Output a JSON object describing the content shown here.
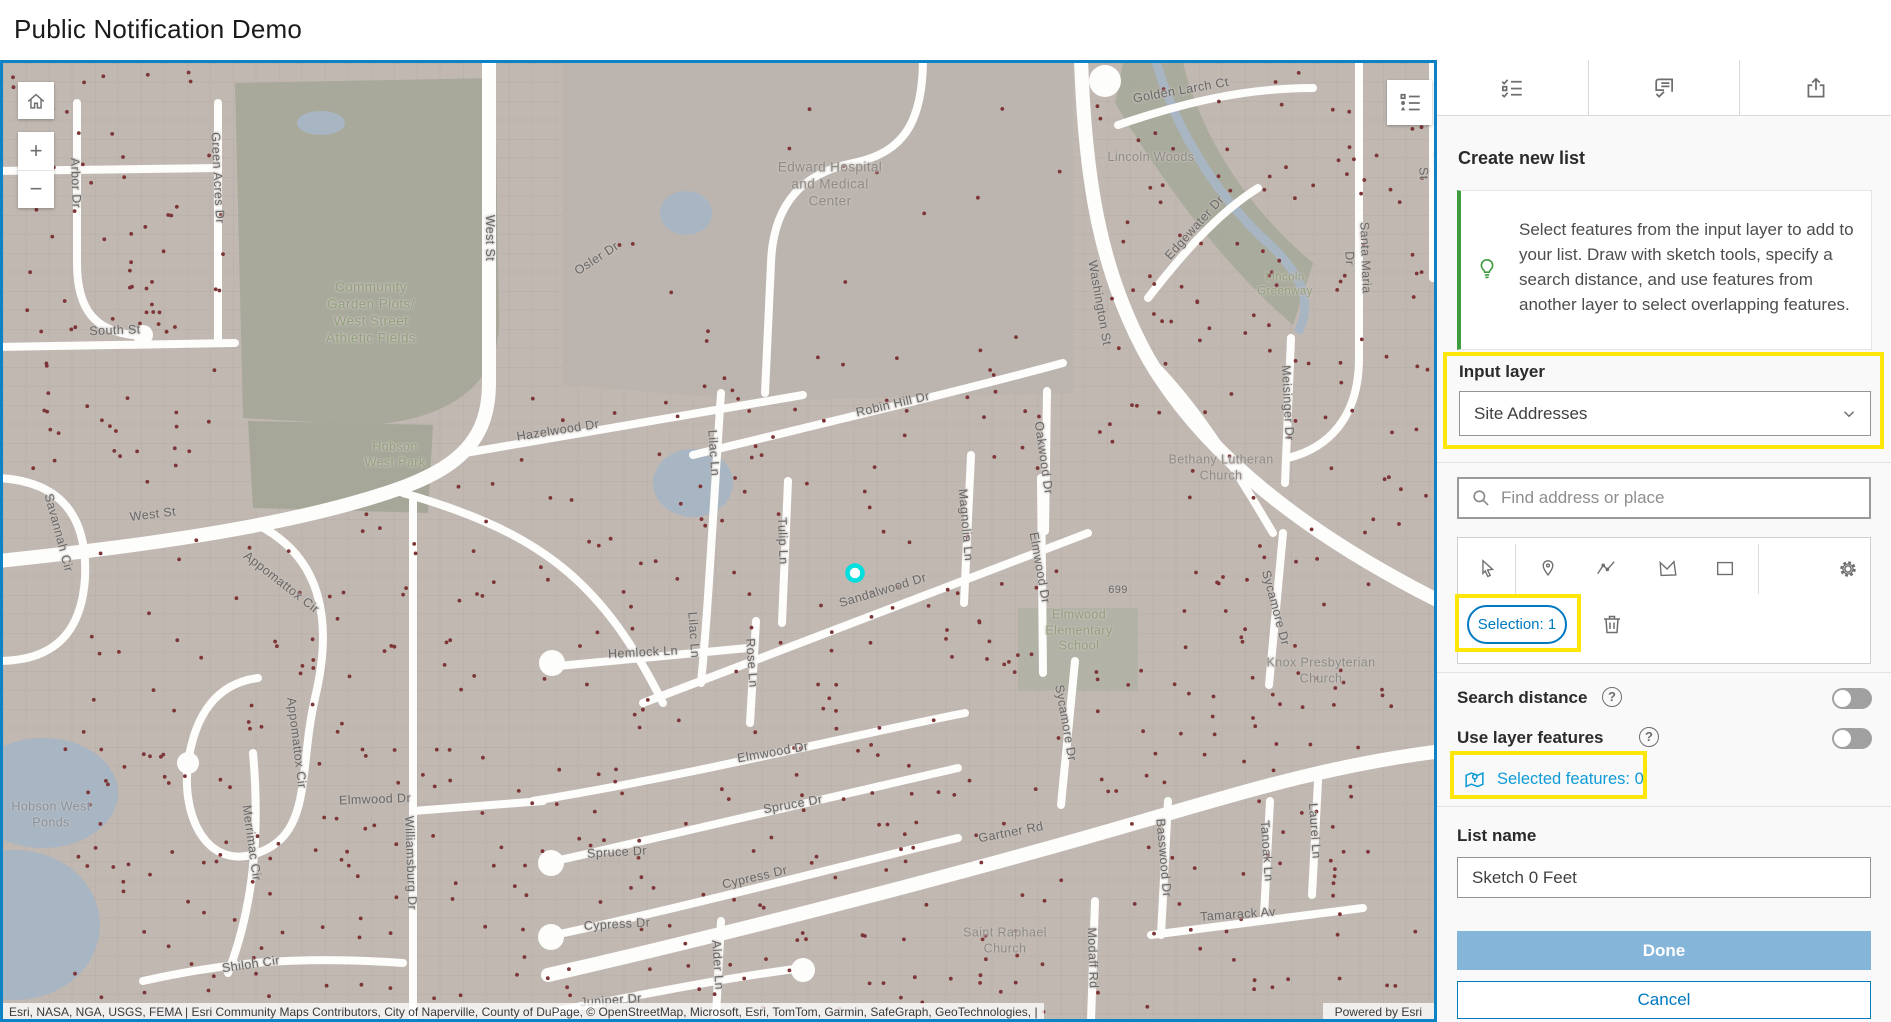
{
  "header": {
    "title": "Public Notification Demo"
  },
  "map": {
    "attribution": "Esri, NASA, NGA, USGS, FEMA | Esri Community Maps Contributors, City of Naperville, County of DuPage, © OpenStreetMap, Microsoft, Esri, TomTom, Garmin, SafeGraph, GeoTechnologies, |",
    "powered_by": "Powered by Esri",
    "controls": {
      "zoom_in": "+",
      "zoom_out": "−"
    },
    "selected_point": {
      "x": 852,
      "y": 510
    },
    "colors": {
      "base": "#c1b8b2",
      "park": "#a8a99b",
      "water": "#a8b5c3",
      "dots": "#7d3537",
      "road": "#fdfdfc",
      "border": "#0d82c4",
      "highlight": "#ffe60a",
      "marker_ring": "#00dede"
    },
    "labels": [
      {
        "t": "West St",
        "x": 486,
        "y": 175,
        "r": 90,
        "c": "st"
      },
      {
        "t": "West St",
        "x": 150,
        "y": 452,
        "r": -7,
        "c": "st"
      },
      {
        "t": "Green Acres Dr",
        "x": 214,
        "y": 115,
        "r": 87,
        "c": "st"
      },
      {
        "t": "Arbor Dr",
        "x": 72,
        "y": 120,
        "r": 88,
        "c": "st"
      },
      {
        "t": "South St",
        "x": 112,
        "y": 268,
        "r": -2,
        "c": "st"
      },
      {
        "t": "Savannah Cir",
        "x": 55,
        "y": 470,
        "r": 75,
        "c": "st"
      },
      {
        "t": "Appomattox Cir",
        "x": 278,
        "y": 520,
        "r": 38,
        "c": "st"
      },
      {
        "t": "Appomattox Cir",
        "x": 293,
        "y": 680,
        "r": 83,
        "c": "st"
      },
      {
        "t": "Merrimac Cir",
        "x": 248,
        "y": 780,
        "r": 82,
        "c": "st"
      },
      {
        "t": "Williamsburg Dr",
        "x": 407,
        "y": 800,
        "r": 88,
        "c": "st"
      },
      {
        "t": "Shiloh Cir",
        "x": 248,
        "y": 902,
        "r": -8,
        "c": "st"
      },
      {
        "t": "Hazelwood Dr",
        "x": 555,
        "y": 368,
        "r": -9,
        "c": "st"
      },
      {
        "t": "Osler Dr",
        "x": 594,
        "y": 196,
        "r": -33,
        "c": "st"
      },
      {
        "t": "Robin Hill Dr",
        "x": 890,
        "y": 342,
        "r": -13,
        "c": "st"
      },
      {
        "t": "Lilac Ln",
        "x": 710,
        "y": 390,
        "r": 86,
        "c": "st"
      },
      {
        "t": "Lilac Ln",
        "x": 690,
        "y": 572,
        "r": 86,
        "c": "st"
      },
      {
        "t": "Tulip Ln",
        "x": 779,
        "y": 478,
        "r": 88,
        "c": "st"
      },
      {
        "t": "Rose Ln",
        "x": 748,
        "y": 600,
        "r": 86,
        "c": "st"
      },
      {
        "t": "Sandalwood Dr",
        "x": 880,
        "y": 528,
        "r": -17,
        "c": "st"
      },
      {
        "t": "Hemlock Ln",
        "x": 640,
        "y": 590,
        "r": -3,
        "c": "st"
      },
      {
        "t": "Elmwood Dr",
        "x": 1036,
        "y": 505,
        "r": 80,
        "c": "st"
      },
      {
        "t": "Elmwood Dr",
        "x": 770,
        "y": 690,
        "r": -10,
        "c": "st"
      },
      {
        "t": "Elmwood Dr",
        "x": 372,
        "y": 737,
        "r": -2,
        "c": "st"
      },
      {
        "t": "Oakwood Dr",
        "x": 1040,
        "y": 395,
        "r": 82,
        "c": "st"
      },
      {
        "t": "Magnolia Ln",
        "x": 962,
        "y": 462,
        "r": 85,
        "c": "st"
      },
      {
        "t": "Spruce Dr",
        "x": 790,
        "y": 742,
        "r": -10,
        "c": "st"
      },
      {
        "t": "Spruce Dr",
        "x": 614,
        "y": 790,
        "r": -3,
        "c": "st"
      },
      {
        "t": "Cypress Dr",
        "x": 752,
        "y": 815,
        "r": -13,
        "c": "st"
      },
      {
        "t": "Cypress Dr",
        "x": 614,
        "y": 862,
        "r": -3,
        "c": "st"
      },
      {
        "t": "Alder Ln",
        "x": 714,
        "y": 902,
        "r": 86,
        "c": "st"
      },
      {
        "t": "Juniper Dr",
        "x": 608,
        "y": 938,
        "r": -4,
        "c": "st"
      },
      {
        "t": "Gartner Rd",
        "x": 1008,
        "y": 770,
        "r": -11,
        "c": "st"
      },
      {
        "t": "Sycamore Dr",
        "x": 1062,
        "y": 660,
        "r": 80,
        "c": "st"
      },
      {
        "t": "Sycamore Dr",
        "x": 1272,
        "y": 545,
        "r": 75,
        "c": "st"
      },
      {
        "t": "Washington St",
        "x": 1096,
        "y": 240,
        "r": 80,
        "c": "st"
      },
      {
        "t": "Edgewater Dr",
        "x": 1192,
        "y": 165,
        "r": -48,
        "c": "st"
      },
      {
        "t": "Santa Maria Dr",
        "x": 1354,
        "y": 195,
        "r": 88,
        "c": "st"
      },
      {
        "t": "Meisinger Dr",
        "x": 1284,
        "y": 340,
        "r": 87,
        "c": "st"
      },
      {
        "t": "Golden Larch Ct",
        "x": 1178,
        "y": 28,
        "r": -10,
        "c": "st"
      },
      {
        "t": "Loomis St",
        "x": 1428,
        "y": 110,
        "r": 88,
        "c": "st"
      },
      {
        "t": "Tamarack Av",
        "x": 1235,
        "y": 852,
        "r": -4,
        "c": "st"
      },
      {
        "t": "Tanoak Ln",
        "x": 1263,
        "y": 788,
        "r": 86,
        "c": "st"
      },
      {
        "t": "Laurel Ln",
        "x": 1311,
        "y": 768,
        "r": 86,
        "c": "st"
      },
      {
        "t": "Basswood Dr",
        "x": 1160,
        "y": 795,
        "r": 85,
        "c": "st"
      },
      {
        "t": "Modaff Rd",
        "x": 1089,
        "y": 895,
        "r": 88,
        "c": "st"
      },
      {
        "t": "699",
        "x": 1115,
        "y": 528,
        "r": 0,
        "c": "st",
        "s": 11
      },
      {
        "t": "Edward Hospital\nand Medical\nCenter",
        "x": 827,
        "y": 122,
        "r": 0,
        "c": "poi",
        "s": 13.5
      },
      {
        "t": "Bethany Lutheran\nChurch",
        "x": 1218,
        "y": 405,
        "r": 0,
        "c": "poi"
      },
      {
        "t": "Knox Presbyterian\nChurch",
        "x": 1318,
        "y": 608,
        "r": 0,
        "c": "poi"
      },
      {
        "t": "Saint Raphael\nChurch",
        "x": 1002,
        "y": 878,
        "r": 0,
        "c": "poi"
      },
      {
        "t": "Lincoln Woods",
        "x": 1148,
        "y": 95,
        "r": 0,
        "c": "poi"
      },
      {
        "t": "Community\nGarden Plots/\nWest Street\nAthletic Fields",
        "x": 368,
        "y": 250,
        "r": 0,
        "c": "park",
        "s": 13.5
      },
      {
        "t": "Hobson\nWest Park",
        "x": 392,
        "y": 392,
        "r": 0,
        "c": "park"
      },
      {
        "t": "Lincoln\nGreenway",
        "x": 1282,
        "y": 222,
        "r": 0,
        "c": "park",
        "s": 11.5
      },
      {
        "t": "Elmwood\nElementary\nSchool",
        "x": 1076,
        "y": 568,
        "r": 0,
        "c": "park"
      },
      {
        "t": "Hobson West\nPonds",
        "x": 48,
        "y": 752,
        "r": 0,
        "c": "water"
      }
    ]
  },
  "panel": {
    "tabs": [
      {
        "name": "create-list"
      },
      {
        "name": "review-list"
      },
      {
        "name": "export-list"
      }
    ],
    "heading": "Create new list",
    "tip": "Select features from the input layer to add to your list. Draw with sketch tools, specify a search distance, and use features from another layer to select overlapping features.",
    "input_layer": {
      "label": "Input layer",
      "value": "Site Addresses"
    },
    "search_placeholder": "Find address or place",
    "selection_badge": "Selection: 1",
    "rows": {
      "search_distance": "Search distance",
      "use_layer_features": "Use layer features",
      "help": "?"
    },
    "selected_features_link": "Selected features: 0",
    "list_name": {
      "label": "List name",
      "value": "Sketch 0 Feet"
    },
    "buttons": {
      "done": "Done",
      "cancel": "Cancel"
    }
  }
}
